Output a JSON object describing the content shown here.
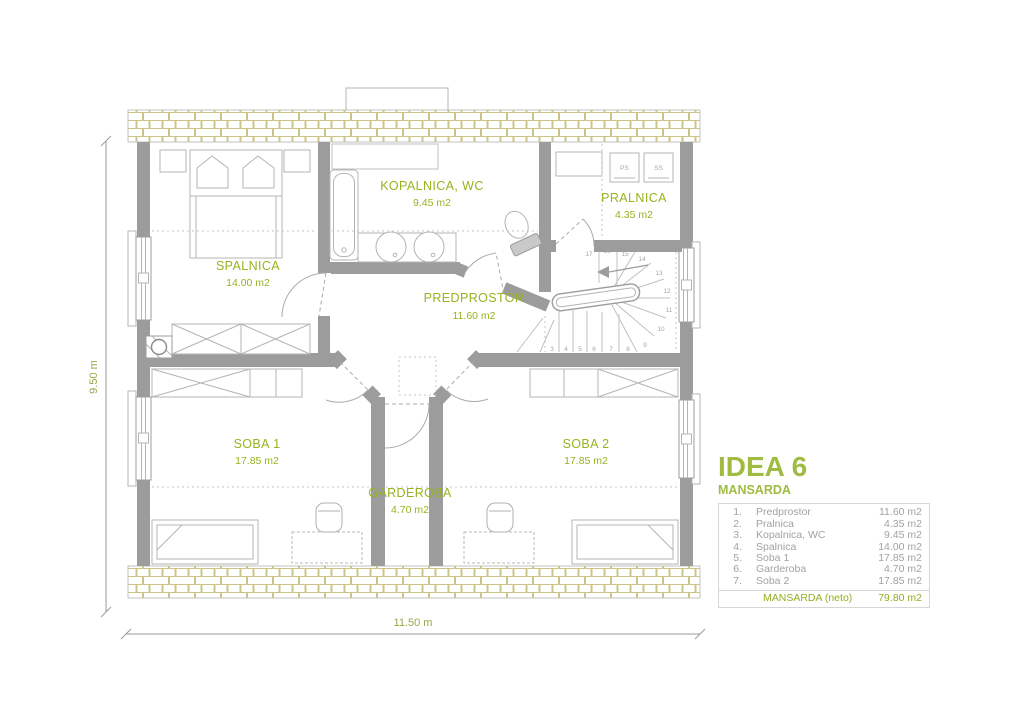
{
  "legend": {
    "title": "IDEA 6",
    "subtitle": "MANSARDA",
    "rows": [
      {
        "num": "1.",
        "name": "Predprostor",
        "area": "11.60 m2"
      },
      {
        "num": "2.",
        "name": "Pralnica",
        "area": "4.35 m2"
      },
      {
        "num": "3.",
        "name": "Kopalnica, WC",
        "area": "9.45 m2"
      },
      {
        "num": "4.",
        "name": "Spalnica",
        "area": "14.00 m2"
      },
      {
        "num": "5.",
        "name": "Soba 1",
        "area": "17.85 m2"
      },
      {
        "num": "6.",
        "name": "Garderoba",
        "area": "4.70 m2"
      },
      {
        "num": "7.",
        "name": "Soba 2",
        "area": "17.85 m2"
      }
    ],
    "total": {
      "name": "MANSARDA (neto)",
      "area": "79.80 m2"
    }
  },
  "rooms": {
    "spalnica": {
      "label": "SPALNICA",
      "area": "14.00 m2"
    },
    "kopalnica": {
      "label": "KOPALNICA, WC",
      "area": "9.45 m2"
    },
    "pralnica": {
      "label": "PRALNICA",
      "area": "4.35 m2"
    },
    "predprostor": {
      "label": "PREDPROSTOR",
      "area": "11.60 m2"
    },
    "soba1": {
      "label": "SOBA 1",
      "area": "17.85 m2"
    },
    "garderoba": {
      "label": "GARDEROBA",
      "area": "4.70 m2"
    },
    "soba2": {
      "label": "SOBA 2",
      "area": "17.85 m2"
    }
  },
  "dimensions": {
    "height": "9.50 m",
    "width": "11.50 m"
  },
  "appliances": {
    "washer": "PS",
    "dryer": "SS"
  },
  "stairs": {
    "steps": [
      "3",
      "4",
      "5",
      "6",
      "7",
      "8",
      "9",
      "10",
      "11",
      "12",
      "13",
      "14",
      "15",
      "16",
      "17"
    ]
  },
  "colors": {
    "accent_green": "#95b41f",
    "title_green": "#9fbc41",
    "total_green": "#8fb01e",
    "wall_gray": "#9c9c9c",
    "furniture_gray": "#b4b4b4",
    "brick_tan": "#cdc48a",
    "legend_text_gray": "#a2a2a2"
  }
}
